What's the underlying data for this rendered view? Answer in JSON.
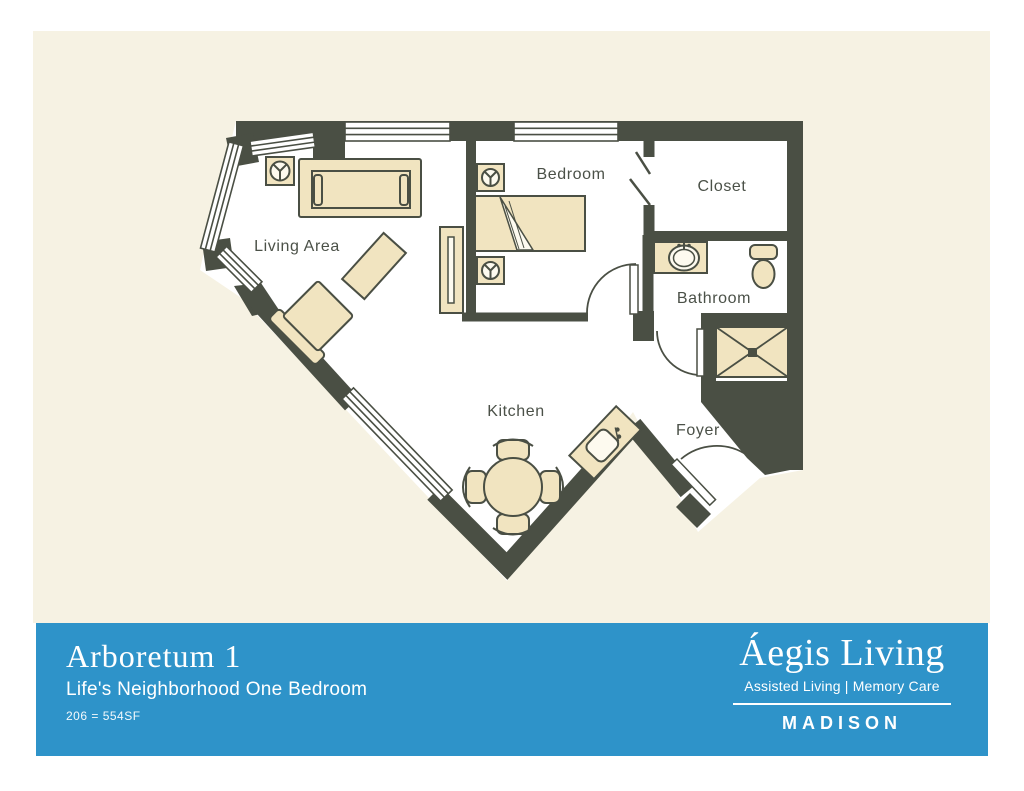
{
  "banner": {
    "title": "Arboretum 1",
    "subtitle": "Life's Neighborhood One Bedroom",
    "unit_info": "206 = 554SF",
    "logo": {
      "brand": "Áegis Living",
      "tagline": "Assisted Living | Memory Care",
      "location": "MADISON"
    }
  },
  "floor_plan": {
    "rooms": [
      {
        "label": "Living Area"
      },
      {
        "label": "Bedroom"
      },
      {
        "label": "Closet"
      },
      {
        "label": "Bathroom"
      },
      {
        "label": "Kitchen"
      },
      {
        "label": "Foyer"
      }
    ],
    "fixtures": [
      "sofa",
      "armchair",
      "coffee-table",
      "side-table",
      "tv-console",
      "bed",
      "nightstand",
      "dining-table-with-chairs",
      "kitchen-sink-counter",
      "bathroom-sink-counter",
      "toilet",
      "shower"
    ]
  },
  "colors": {
    "background_cream": "#f6f2e3",
    "banner_blue": "#2e93c9",
    "wall": "#4a4f44",
    "floor": "#ffffff",
    "furniture_fill": "#f1e4c0",
    "label_text": "#4b5148",
    "text_on_banner": "#ffffff"
  }
}
